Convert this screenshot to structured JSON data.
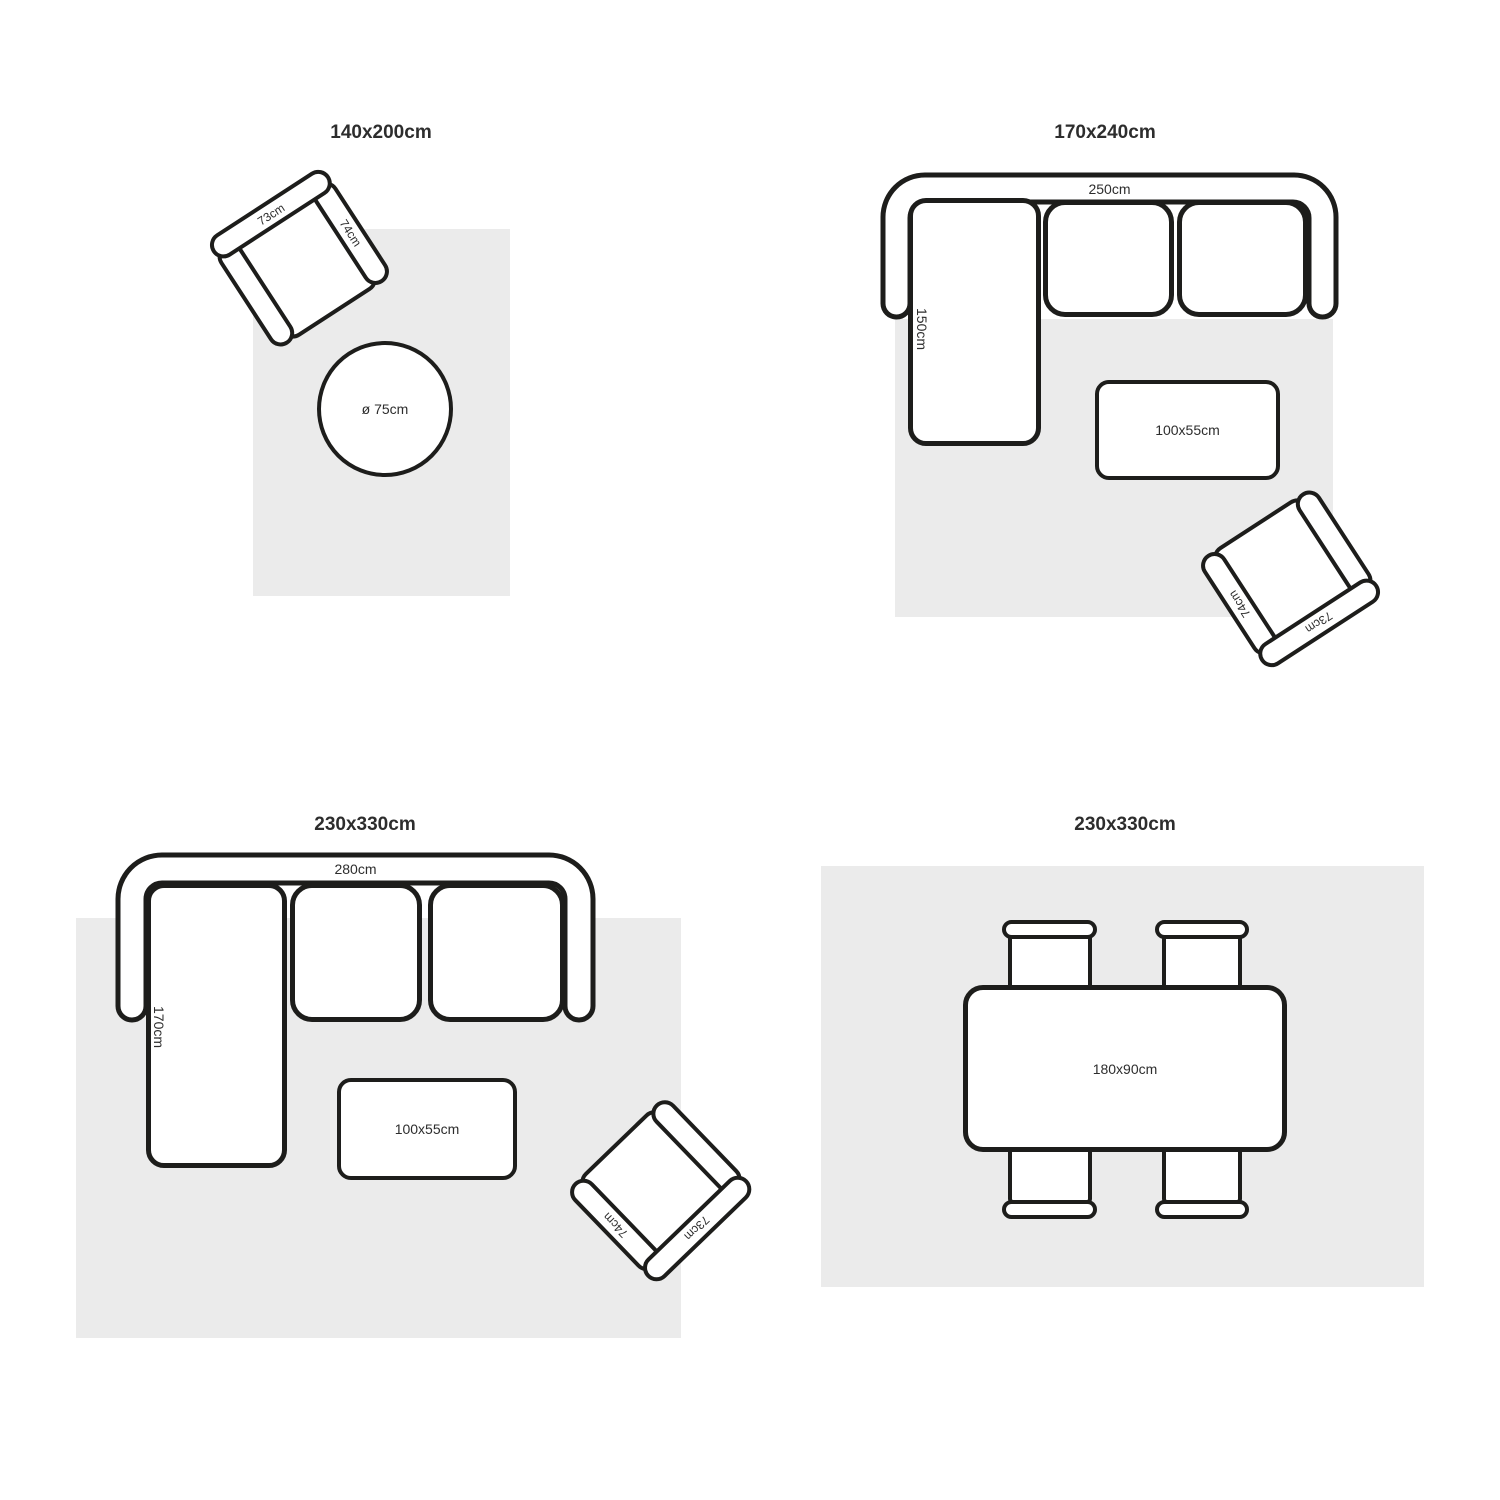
{
  "colors": {
    "stroke": "#1d1d1b",
    "rug": "#ebebeb",
    "text": "#2d2d2d",
    "bg": "#ffffff"
  },
  "quadrants": [
    {
      "title": "140x200cm",
      "armchair": {
        "back": "73cm",
        "side": "74cm"
      },
      "round_table": "ø 75cm"
    },
    {
      "title": "170x240cm",
      "sofa": {
        "width": "250cm",
        "depth": "150cm"
      },
      "coffee_table": "100x55cm",
      "armchair": {
        "back": "73cm",
        "side": "74cm"
      }
    },
    {
      "title": "230x330cm",
      "sofa": {
        "width": "280cm",
        "depth": "170cm"
      },
      "coffee_table": "100x55cm",
      "armchair": {
        "back": "73cm",
        "side": "74cm"
      }
    },
    {
      "title": "230x330cm",
      "dining_table": "180x90cm"
    }
  ]
}
